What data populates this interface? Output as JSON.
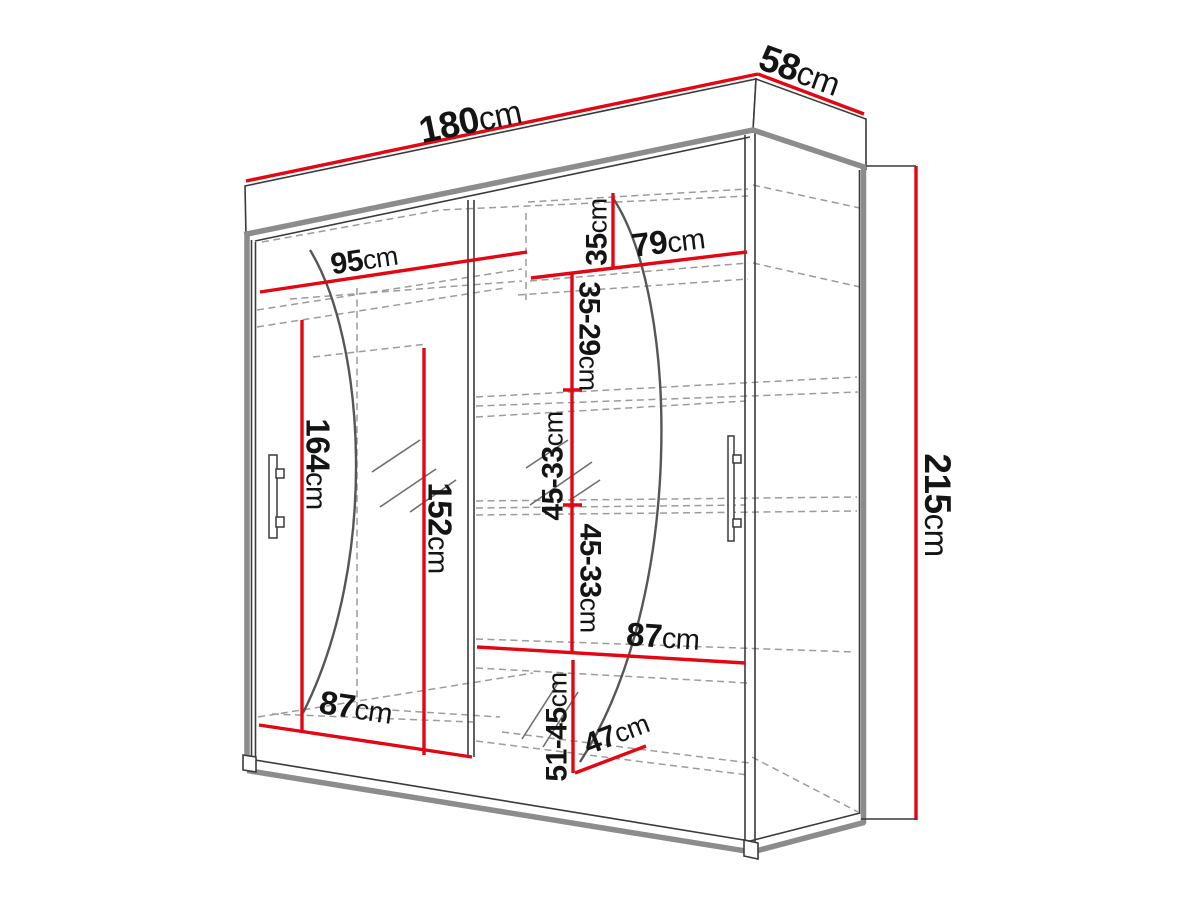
{
  "diagram": {
    "type": "wardrobe-dimension-diagram",
    "unit": "cm",
    "overall": {
      "width": "180cm",
      "depth": "58cm",
      "height": "215cm"
    },
    "colors": {
      "dimension_line": "#e30613",
      "outline": "#3a3a3a",
      "thick_edge": "#8c8c8c",
      "hidden_line": "#9c9c9c",
      "label_text": "#141414",
      "background": "#ffffff"
    },
    "labels": [
      {
        "id": "width-total",
        "text": "180cm"
      },
      {
        "id": "depth-total",
        "text": "58cm"
      },
      {
        "id": "height-total",
        "text": "215cm"
      },
      {
        "id": "left-section-width",
        "text": "95cm"
      },
      {
        "id": "right-section-width",
        "text": "79cm"
      },
      {
        "id": "right-top-gap",
        "text": "35cm"
      },
      {
        "id": "right-shelf-gap-2",
        "text": "35-29cm"
      },
      {
        "id": "right-shelf-gap-3",
        "text": "45-33cm"
      },
      {
        "id": "right-shelf-gap-4",
        "text": "45-33cm"
      },
      {
        "id": "left-hanging-height",
        "text": "164cm"
      },
      {
        "id": "door-mirror-height",
        "text": "152cm"
      },
      {
        "id": "bottom-left-width",
        "text": "87cm"
      },
      {
        "id": "middle-shelf-width",
        "text": "87cm"
      },
      {
        "id": "right-bottom-gap",
        "text": "51-45cm"
      },
      {
        "id": "bottom-depth",
        "text": "47cm"
      }
    ]
  }
}
